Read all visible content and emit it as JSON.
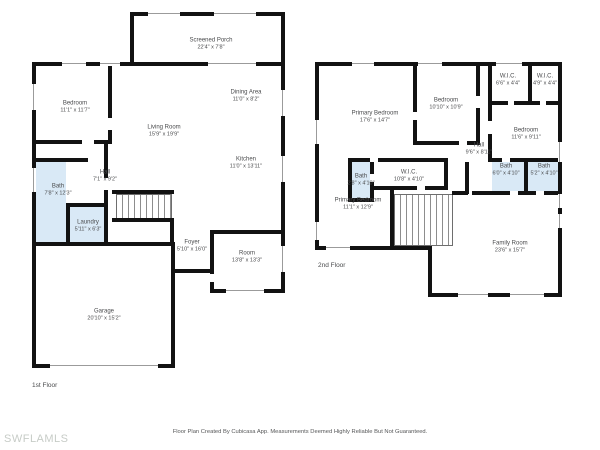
{
  "meta": {
    "footer_disclaimer": "Floor Plan Created By Cubicasa App. Measurements Deemed Highly Reliable But Not Guaranteed.",
    "watermark": "SWFLAMLS"
  },
  "colors": {
    "wall": "#121212",
    "wet_room_fill": "#d9e9f6",
    "label_text": "#4a4b4d",
    "watermark_text": "#c7ccc7"
  },
  "floors": [
    {
      "floor_label": "1st Floor",
      "rooms": [
        {
          "name": "Screened Porch",
          "dims": "22'4\" x 7'8\""
        },
        {
          "name": "Bedroom",
          "dims": "11'1\" x 11'7\""
        },
        {
          "name": "Living Room",
          "dims": "15'9\" x 19'9\""
        },
        {
          "name": "Dining Area",
          "dims": "11'0\" x 8'2\""
        },
        {
          "name": "Kitchen",
          "dims": "11'0\" x 13'11\""
        },
        {
          "name": "Hall",
          "dims": "7'1\" x 9'2\""
        },
        {
          "name": "Bath",
          "dims": "7'8\" x 12'3\""
        },
        {
          "name": "Laundry",
          "dims": "5'11\" x 6'3\""
        },
        {
          "name": "Foyer",
          "dims": "5'10\" x 16'0\""
        },
        {
          "name": "Room",
          "dims": "13'8\" x 13'3\""
        },
        {
          "name": "Garage",
          "dims": "20'10\" x 15'2\""
        }
      ]
    },
    {
      "floor_label": "2nd Floor",
      "rooms": [
        {
          "name": "Primary Bedroom",
          "dims": "17'6\" x 14'7\""
        },
        {
          "name": "Bedroom",
          "dims": "10'10\" x 10'9\""
        },
        {
          "name": "W.I.C.",
          "dims": "6'6\" x 4'4\""
        },
        {
          "name": "W.I.C.",
          "dims": "4'9\" x 4'4\""
        },
        {
          "name": "Bedroom",
          "dims": "11'6\" x 9'11\""
        },
        {
          "name": "Hall",
          "dims": "9'6\" x 8'11\""
        },
        {
          "name": "Bath",
          "dims": "2'8\" x 4'10\""
        },
        {
          "name": "W.I.C.",
          "dims": "10'8\" x 4'10\""
        },
        {
          "name": "Primary Bedroom",
          "dims": "11'1\" x 12'9\""
        },
        {
          "name": "Bath",
          "dims": "6'0\" x 4'10\""
        },
        {
          "name": "Bath",
          "dims": "5'2\" x 4'10\""
        },
        {
          "name": "Family Room",
          "dims": "23'6\" x 15'7\""
        }
      ]
    }
  ]
}
